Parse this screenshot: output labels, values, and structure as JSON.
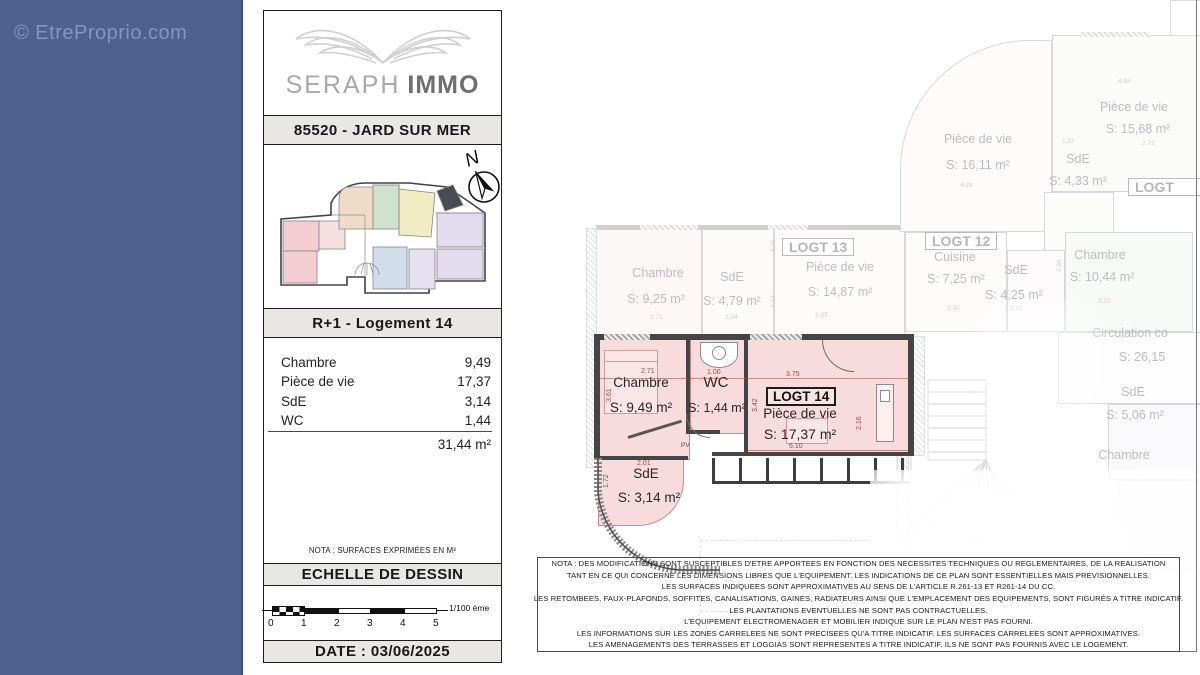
{
  "watermark": "© EtreProprio.com",
  "colors": {
    "band": "#4e6292",
    "highlight_fill": "#f8dcdd",
    "dim_text": "#9c4a3c"
  },
  "titleblock": {
    "brand_light": "SERAPH",
    "brand_bold": "IMMO",
    "address": "85520 - JARD SUR MER",
    "north_letter": "N",
    "unit_title": "R+1 - Logement 14",
    "surface_rows": [
      {
        "label": "Chambre",
        "value": "9,49"
      },
      {
        "label": "Pièce de vie",
        "value": "17,37"
      },
      {
        "label": "SdE",
        "value": "3,14"
      },
      {
        "label": "WC",
        "value": "1,44"
      }
    ],
    "total": "31,44 m²",
    "nota": "NOTA : SURFACES EXPRIMÉES EN M²",
    "scale_title": "ECHELLE DE DESSIN",
    "scale_ticks": [
      "0",
      "1",
      "2",
      "3",
      "4",
      "5"
    ],
    "scale_ratio": "1/100 ème",
    "date": "DATE : 03/06/2025"
  },
  "plan": {
    "unit": {
      "logt": "LOGT 14",
      "chambre_name": "Chambre",
      "chambre_area": "S: 9,49 m²",
      "wc_name": "WC",
      "wc_area": "S: 1,44 m²",
      "pdv_name": "Pièce de vie",
      "pdv_area": "S: 17,37 m²",
      "sde_name": "SdE",
      "sde_area": "S: 3,14 m²",
      "pv": "PV",
      "dims": {
        "chambre_w": "2.71",
        "chambre_h": "3.61",
        "wc_w": "1.00",
        "pdv_top": "3.75",
        "pdv_left": "3.42",
        "pdv_right": "2.16",
        "pdv_bottom": "6.10",
        "sde_w": "2.01",
        "sde_h": "1.72"
      }
    },
    "faded": {
      "logt13": "LOGT 13",
      "logt13_chambre_name": "Chambre",
      "logt13_chambre_area": "S: 9,25 m²",
      "logt13_chambre_dim": "2.71",
      "logt13_sde_name": "SdE",
      "logt13_sde_area": "S: 4,79 m²",
      "logt13_sde_dim": "2.04",
      "logt13_pdv_name": "Pièce de vie",
      "logt13_pdv_area": "S: 14,87 m²",
      "logt13_pdv_dim": "3.97",
      "logt13_dim_v1": "1.01",
      "logt13_dim_v2": "3.42",
      "pdv16_name": "Pièce de vie",
      "pdv16_area": "S: 16,11 m²",
      "pdv16_dim": "4.28",
      "pdv15_name": "Pièce de vie",
      "pdv15_area": "S: 15,68 m²",
      "pdv15_dim_top": "4.68",
      "pdv15_dim": "2.73",
      "sde433_name": "SdE",
      "sde433_area": "S: 4,33 m²",
      "sde433_dim": "1.87",
      "logt_cut": "LOGT",
      "logt12": "LOGT 12",
      "cuisine_name": "Cuisine",
      "cuisine_area": "S: 7,25 m²",
      "cuisine_dim": "2.37",
      "sde425_name": "SdE",
      "sde425_area": "S: 4,25 m²",
      "sde425_dim": "1.41",
      "chambre1044_name": "Chambre",
      "chambre1044_area": "S: 10,44 m²",
      "chambre1044_dim": "3.37",
      "chambre1044_dim_v": "2.86",
      "circulation_name": "Circulation co",
      "circulation_area": "S: 26,15",
      "sde506_name": "SdE",
      "sde506_area": "S: 5,06 m²",
      "chambre_br_name": "Chambre"
    },
    "disclaimer": [
      "NOTA : DES MODIFICATIONS SONT SUSCEPTIBLES D'ETRE APPORTEES EN FONCTION DES NECESSITES TECHNIQUES OU REGLEMENTAIRES, DE LA REALISATION",
      "TANT EN CE QUI CONCERNE LES DIMENSIONS LIBRES QUE L'EQUIPEMENT. LES INDICATIONS DE CE PLAN SONT ESSENTIELLES MAIS PREVISIONNELLES.",
      "LES SURFACES INDIQUEES SONT APPROXIMATIVES AU SENS DE L'ARTICLE R.261-13 ET R261-14 DU CC.",
      "LES RETOMBEES, FAUX-PLAFONDS, SOFFITES, CANALISATIONS, GAINES, RADIATEURS AINSI QUE L'EMPLACEMENT DES EQUIPEMENTS, SONT FIGURÉS A TITRE INDICATIF.",
      "LES PLANTATIONS EVENTUELLES NE SONT PAS CONTRACTUELLES.",
      "L'EQUIPEMENT ELECTROMENAGER ET MOBILIER INDIQUE SUR LE PLAN N'EST PAS FOURNI.",
      "LES INFORMATIONS SUR LES ZONES CARRELEES NE SONT PRECISEES QU'A TITRE INDICATIF. LES SURFACES CARRELEES SONT APPROXIMATIVES.",
      "LES AMENAGEMENTS DES TERRASSES ET LOGGIAS SONT REPRESENTES A TITRE INDICATIF. ILS NE SONT PAS FOURNIS AVEC LE LOGEMENT."
    ]
  }
}
